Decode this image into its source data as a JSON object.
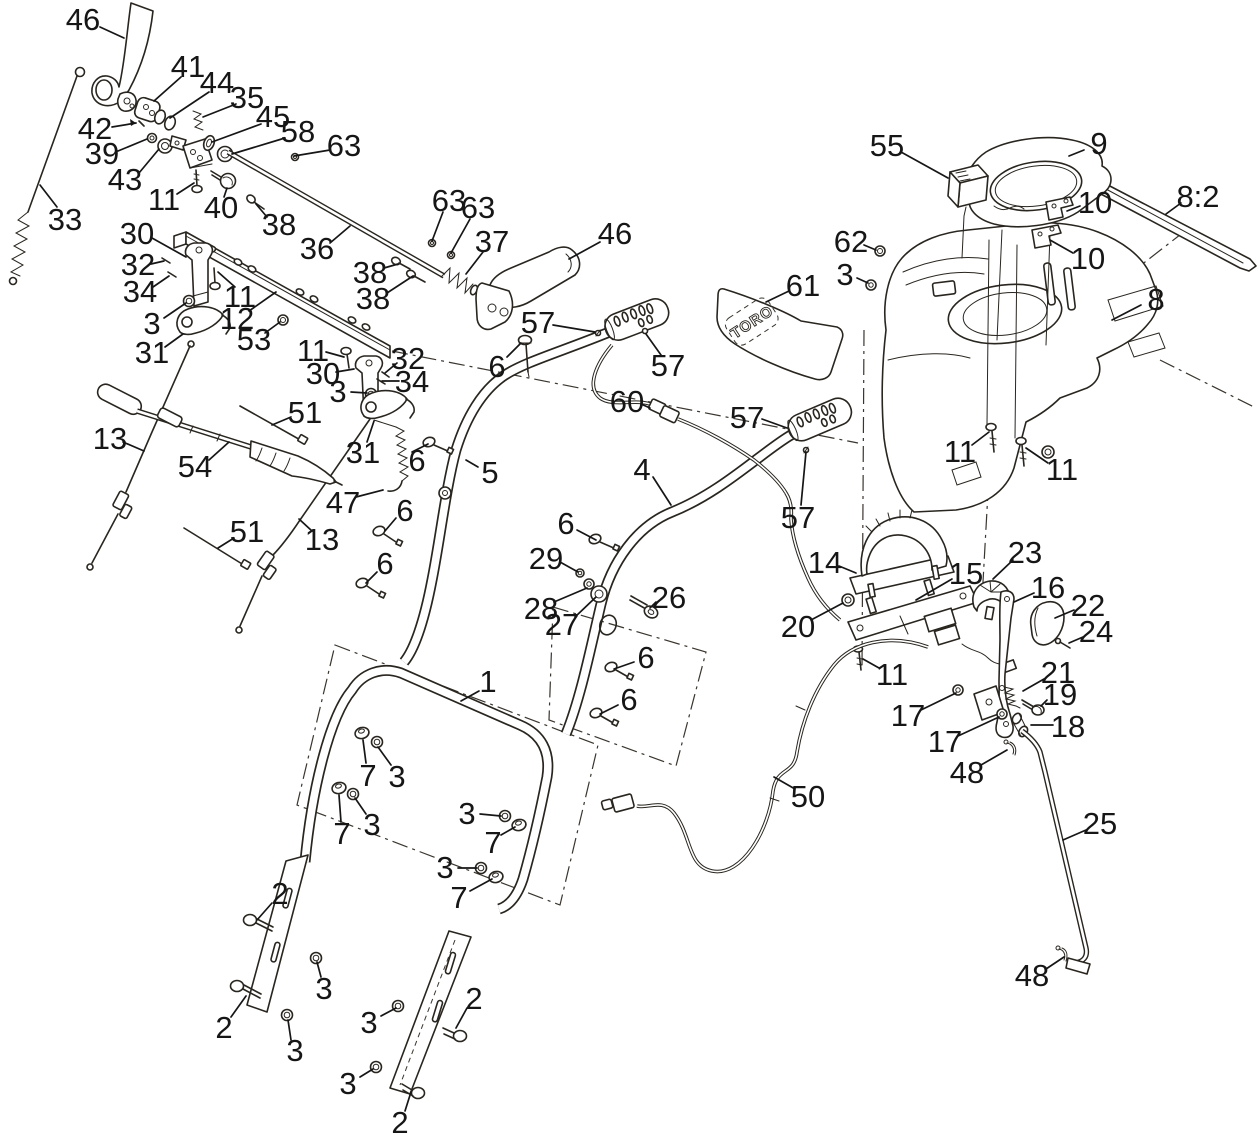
{
  "diagram": {
    "background": "#ffffff",
    "line_color": "#29251f",
    "label_color": "#161616",
    "label_font_size": 31,
    "decal_text": "TORO",
    "callouts": [
      {
        "n": "46",
        "x": 83,
        "y": 19,
        "l": [
          100,
          27,
          124,
          38
        ]
      },
      {
        "n": "41",
        "x": 188,
        "y": 66,
        "l": [
          181,
          77,
          154,
          101
        ]
      },
      {
        "n": "44",
        "x": 217,
        "y": 82,
        "l": [
          209,
          92,
          170,
          118
        ]
      },
      {
        "n": "35",
        "x": 247,
        "y": 97,
        "l": [
          236,
          104,
          203,
          117
        ]
      },
      {
        "n": "45",
        "x": 273,
        "y": 116,
        "l": [
          261,
          124,
          212,
          142
        ]
      },
      {
        "n": "58",
        "x": 298,
        "y": 131,
        "l": [
          285,
          138,
          232,
          154
        ]
      },
      {
        "n": "63",
        "x": 344,
        "y": 145,
        "l": [
          330,
          150,
          294,
          156
        ]
      },
      {
        "n": "42",
        "x": 95,
        "y": 128,
        "l": [
          112,
          127,
          136,
          123
        ]
      },
      {
        "n": "39",
        "x": 102,
        "y": 153,
        "l": [
          118,
          151,
          147,
          139
        ]
      },
      {
        "n": "43",
        "x": 125,
        "y": 179,
        "l": [
          139,
          173,
          159,
          149
        ]
      },
      {
        "n": "11",
        "x": 164,
        "y": 199,
        "l": [
          177,
          194,
          194,
          183
        ]
      },
      {
        "n": "40",
        "x": 221,
        "y": 207,
        "l": [
          224,
          197,
          227,
          188
        ]
      },
      {
        "n": "38",
        "x": 279,
        "y": 224,
        "l": [
          267,
          217,
          256,
          204
        ]
      },
      {
        "n": "36",
        "x": 317,
        "y": 248,
        "l": [
          330,
          243,
          350,
          226
        ]
      },
      {
        "n": "33",
        "x": 65,
        "y": 219,
        "l": [
          57,
          207,
          40,
          185
        ]
      },
      {
        "n": "30",
        "x": 137,
        "y": 233,
        "l": [
          152,
          238,
          186,
          257
        ]
      },
      {
        "n": "32",
        "x": 138,
        "y": 264,
        "l": [
          151,
          264,
          164,
          261
        ]
      },
      {
        "n": "34",
        "x": 140,
        "y": 291,
        "l": [
          153,
          287,
          169,
          276
        ]
      },
      {
        "n": "3",
        "x": 152,
        "y": 323,
        "l": [
          164,
          318,
          186,
          303
        ]
      },
      {
        "n": "31",
        "x": 152,
        "y": 352,
        "l": [
          165,
          347,
          183,
          334
        ]
      },
      {
        "n": "11",
        "x": 240,
        "y": 296,
        "l": [
          235,
          287,
          218,
          272
        ]
      },
      {
        "n": "12",
        "x": 237,
        "y": 318,
        "l": [
          249,
          311,
          276,
          292
        ]
      },
      {
        "n": "53",
        "x": 254,
        "y": 339,
        "l": [
          265,
          333,
          280,
          322
        ]
      },
      {
        "n": "11",
        "x": 313,
        "y": 350,
        "l": [
          326,
          352,
          344,
          357
        ]
      },
      {
        "n": "30",
        "x": 323,
        "y": 373,
        "l": [
          336,
          372,
          354,
          369
        ]
      },
      {
        "n": "32",
        "x": 408,
        "y": 358,
        "l": [
          397,
          363,
          385,
          373
        ]
      },
      {
        "n": "34",
        "x": 412,
        "y": 381,
        "l": [
          399,
          381,
          382,
          381
        ]
      },
      {
        "n": "3",
        "x": 338,
        "y": 391,
        "l": [
          351,
          392,
          367,
          393
        ]
      },
      {
        "n": "31",
        "x": 363,
        "y": 452,
        "l": [
          367,
          442,
          374,
          421
        ]
      },
      {
        "n": "51",
        "x": 305,
        "y": 412,
        "l": [
          291,
          417,
          272,
          425
        ]
      },
      {
        "n": "13",
        "x": 110,
        "y": 438,
        "l": [
          123,
          442,
          144,
          451
        ]
      },
      {
        "n": "54",
        "x": 195,
        "y": 466,
        "l": [
          209,
          460,
          229,
          442
        ]
      },
      {
        "n": "51",
        "x": 247,
        "y": 531,
        "l": [
          234,
          538,
          218,
          548
        ]
      },
      {
        "n": "13",
        "x": 322,
        "y": 539,
        "l": [
          312,
          531,
          299,
          519
        ]
      },
      {
        "n": "47",
        "x": 343,
        "y": 502,
        "l": [
          356,
          497,
          383,
          490
        ]
      },
      {
        "n": "6",
        "x": 417,
        "y": 460,
        "l": [
          412,
          452,
          428,
          444
        ]
      },
      {
        "n": "6",
        "x": 405,
        "y": 510,
        "l": [
          396,
          518,
          385,
          531
        ]
      },
      {
        "n": "6",
        "x": 385,
        "y": 563,
        "l": [
          377,
          572,
          366,
          583
        ]
      },
      {
        "n": "5",
        "x": 490,
        "y": 472,
        "l": [
          478,
          467,
          466,
          460
        ]
      },
      {
        "n": "63",
        "x": 449,
        "y": 200,
        "l": [
          443,
          212,
          432,
          241
        ]
      },
      {
        "n": "63",
        "x": 478,
        "y": 207,
        "l": [
          470,
          219,
          451,
          253
        ]
      },
      {
        "n": "37",
        "x": 492,
        "y": 241,
        "l": [
          483,
          252,
          466,
          274
        ]
      },
      {
        "n": "46",
        "x": 615,
        "y": 233,
        "l": [
          600,
          242,
          569,
          259
        ]
      },
      {
        "n": "57",
        "x": 538,
        "y": 322,
        "l": [
          553,
          325,
          595,
          332
        ]
      },
      {
        "n": "57",
        "x": 668,
        "y": 365,
        "l": [
          661,
          355,
          646,
          334
        ]
      },
      {
        "n": "6",
        "x": 497,
        "y": 366,
        "l": [
          507,
          357,
          521,
          343
        ]
      },
      {
        "n": "60",
        "x": 627,
        "y": 401,
        "l": [
          641,
          404,
          650,
          408
        ]
      },
      {
        "n": "57",
        "x": 747,
        "y": 417,
        "l": [
          762,
          419,
          787,
          428
        ]
      },
      {
        "n": "4",
        "x": 642,
        "y": 469,
        "l": [
          653,
          477,
          671,
          505
        ]
      },
      {
        "n": "57",
        "x": 798,
        "y": 517,
        "l": [
          801,
          505,
          806,
          452
        ]
      },
      {
        "n": "61",
        "x": 803,
        "y": 285,
        "l": [
          789,
          291,
          766,
          302
        ]
      },
      {
        "n": "55",
        "x": 887,
        "y": 145,
        "l": [
          901,
          152,
          948,
          178
        ]
      },
      {
        "n": "9",
        "x": 1099,
        "y": 143,
        "l": [
          1084,
          150,
          1069,
          156
        ]
      },
      {
        "n": "10",
        "x": 1095,
        "y": 202,
        "l": [
          1080,
          206,
          1067,
          211
        ]
      },
      {
        "n": "10",
        "x": 1088,
        "y": 258,
        "l": [
          1073,
          253,
          1050,
          240
        ]
      },
      {
        "n": "8:2",
        "x": 1198,
        "y": 196,
        "l": [
          1181,
          203,
          1166,
          214
        ]
      },
      {
        "n": "62",
        "x": 851,
        "y": 241,
        "l": [
          864,
          245,
          876,
          250
        ]
      },
      {
        "n": "3",
        "x": 845,
        "y": 274,
        "l": [
          857,
          278,
          868,
          283
        ]
      },
      {
        "n": "8",
        "x": 1156,
        "y": 299,
        "l": [
          1141,
          305,
          1112,
          320
        ]
      },
      {
        "n": "11",
        "x": 960,
        "y": 451,
        "l": [
          972,
          445,
          989,
          432
        ]
      },
      {
        "n": "11",
        "x": 1062,
        "y": 469,
        "l": [
          1048,
          463,
          1026,
          448
        ]
      },
      {
        "n": "14",
        "x": 825,
        "y": 562,
        "l": [
          839,
          566,
          856,
          573
        ]
      },
      {
        "n": "15",
        "x": 966,
        "y": 573,
        "l": [
          952,
          579,
          916,
          600
        ]
      },
      {
        "n": "23",
        "x": 1025,
        "y": 552,
        "l": [
          1013,
          560,
          993,
          579
        ]
      },
      {
        "n": "16",
        "x": 1048,
        "y": 587,
        "l": [
          1034,
          593,
          1014,
          602
        ]
      },
      {
        "n": "22",
        "x": 1088,
        "y": 605,
        "l": [
          1074,
          610,
          1055,
          618
        ]
      },
      {
        "n": "24",
        "x": 1096,
        "y": 631,
        "l": [
          1083,
          637,
          1069,
          643
        ]
      },
      {
        "n": "21",
        "x": 1058,
        "y": 672,
        "l": [
          1044,
          679,
          1023,
          691
        ]
      },
      {
        "n": "19",
        "x": 1060,
        "y": 694,
        "l": [
          1047,
          700,
          1041,
          706
        ]
      },
      {
        "n": "18",
        "x": 1068,
        "y": 726,
        "l": [
          1053,
          725,
          1031,
          725
        ]
      },
      {
        "n": "17",
        "x": 908,
        "y": 715,
        "l": [
          921,
          710,
          956,
          693
        ]
      },
      {
        "n": "17",
        "x": 945,
        "y": 741,
        "l": [
          958,
          736,
          999,
          717
        ]
      },
      {
        "n": "20",
        "x": 798,
        "y": 626,
        "l": [
          811,
          620,
          843,
          603
        ]
      },
      {
        "n": "11",
        "x": 892,
        "y": 674,
        "l": [
          879,
          668,
          863,
          659
        ]
      },
      {
        "n": "48",
        "x": 967,
        "y": 772,
        "l": [
          981,
          765,
          1007,
          750
        ]
      },
      {
        "n": "50",
        "x": 808,
        "y": 796,
        "l": [
          795,
          789,
          774,
          777
        ]
      },
      {
        "n": "25",
        "x": 1100,
        "y": 823,
        "l": [
          1086,
          830,
          1063,
          840
        ]
      },
      {
        "n": "48",
        "x": 1032,
        "y": 975,
        "l": [
          1046,
          969,
          1064,
          957
        ]
      },
      {
        "n": "29",
        "x": 546,
        "y": 558,
        "l": [
          560,
          562,
          578,
          572
        ]
      },
      {
        "n": "28",
        "x": 541,
        "y": 608,
        "l": [
          554,
          602,
          587,
          588
        ]
      },
      {
        "n": "27",
        "x": 562,
        "y": 624,
        "l": [
          575,
          617,
          596,
          597
        ]
      },
      {
        "n": "26",
        "x": 669,
        "y": 597,
        "l": [
          656,
          602,
          650,
          608
        ]
      },
      {
        "n": "6",
        "x": 566,
        "y": 523,
        "l": [
          577,
          530,
          596,
          540
        ]
      },
      {
        "n": "6",
        "x": 646,
        "y": 657,
        "l": [
          634,
          662,
          614,
          669
        ]
      },
      {
        "n": "6",
        "x": 629,
        "y": 699,
        "l": [
          618,
          705,
          600,
          714
        ]
      },
      {
        "n": "1",
        "x": 488,
        "y": 681,
        "l": [
          479,
          691,
          461,
          701
        ]
      },
      {
        "n": "7",
        "x": 368,
        "y": 775,
        "l": [
          366,
          763,
          363,
          740
        ]
      },
      {
        "n": "3",
        "x": 397,
        "y": 776,
        "l": [
          391,
          765,
          378,
          747
        ]
      },
      {
        "n": "7",
        "x": 342,
        "y": 833,
        "l": [
          341,
          822,
          339,
          795
        ]
      },
      {
        "n": "3",
        "x": 372,
        "y": 824,
        "l": [
          366,
          814,
          355,
          798
        ]
      },
      {
        "n": "3",
        "x": 467,
        "y": 813,
        "l": [
          480,
          814,
          501,
          816
        ]
      },
      {
        "n": "7",
        "x": 493,
        "y": 842,
        "l": [
          501,
          835,
          515,
          827
        ]
      },
      {
        "n": "3",
        "x": 445,
        "y": 867,
        "l": [
          458,
          868,
          477,
          868
        ]
      },
      {
        "n": "7",
        "x": 459,
        "y": 897,
        "l": [
          470,
          891,
          492,
          879
        ]
      },
      {
        "n": "2",
        "x": 280,
        "y": 893,
        "l": [
          272,
          903,
          257,
          920
        ]
      },
      {
        "n": "3",
        "x": 324,
        "y": 988,
        "l": [
          321,
          977,
          317,
          962
        ]
      },
      {
        "n": "2",
        "x": 224,
        "y": 1027,
        "l": [
          231,
          1017,
          246,
          996
        ]
      },
      {
        "n": "3",
        "x": 295,
        "y": 1050,
        "l": [
          291,
          1040,
          288,
          1020
        ]
      },
      {
        "n": "3",
        "x": 369,
        "y": 1022,
        "l": [
          381,
          1016,
          396,
          1008
        ]
      },
      {
        "n": "2",
        "x": 474,
        "y": 998,
        "l": [
          467,
          1008,
          456,
          1028
        ]
      },
      {
        "n": "3",
        "x": 348,
        "y": 1083,
        "l": [
          360,
          1077,
          373,
          1069
        ]
      },
      {
        "n": "2",
        "x": 400,
        "y": 1122,
        "l": [
          405,
          1111,
          411,
          1092
        ]
      },
      {
        "n": "38",
        "x": 370,
        "y": 272,
        "l": [
          384,
          268,
          398,
          264
        ]
      },
      {
        "n": "38",
        "x": 373,
        "y": 298,
        "l": [
          387,
          293,
          413,
          276
        ]
      }
    ]
  }
}
